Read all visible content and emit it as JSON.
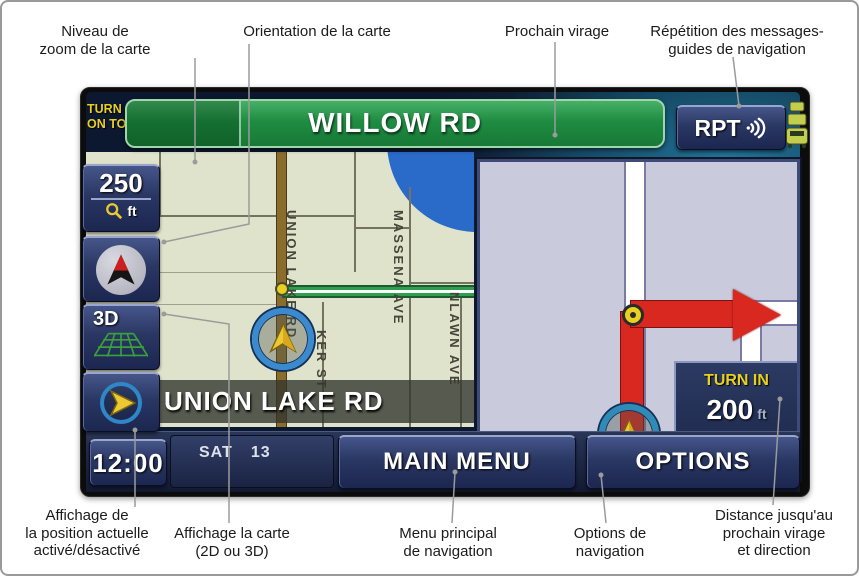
{
  "callouts": {
    "top": [
      {
        "label": "Niveau de\nzoom de la carte"
      },
      {
        "label": "Orientation de la carte"
      },
      {
        "label": "Prochain virage"
      },
      {
        "label": "Répétition des messages-\nguides de navigation"
      }
    ],
    "bottom": [
      {
        "label": "Affichage de\nla position actuelle\nactivé/désactivé"
      },
      {
        "label": "Affichage la carte\n(2D ou 3D)"
      },
      {
        "label": "Menu principal\nde navigation"
      },
      {
        "label": "Options de\nnavigation"
      },
      {
        "label": "Distance jusqu'au\nprochain virage\net direction"
      }
    ]
  },
  "screen": {
    "turn_on_to": "TURN\nON TO",
    "banner": {
      "street": "WILLOW RD"
    },
    "rpt": {
      "label": "RPT",
      "icon": "sound-waves-icon"
    },
    "traffic_icon": "car-stack-icon",
    "zoom_button": {
      "value": "250",
      "unit": "ft",
      "icon": "magnifier-icon"
    },
    "orientation_button": {
      "icon": "north-arrow-icon"
    },
    "view_button": {
      "label": "3D",
      "icon": "grid-3d-icon"
    },
    "position_button": {
      "icon": "position-arrow-icon"
    },
    "map": {
      "current_street": "UNION LAKE RD",
      "streets": {
        "union": "UNION LAKE RD",
        "ker": "KER ST",
        "massena": "MASSENA AVE",
        "nlawn": "NLAWN AVE"
      }
    },
    "turn_panel": {
      "label": "TURN IN",
      "distance": "200",
      "unit": "ft"
    },
    "status_bar": {
      "clock": "12:00",
      "day": "SAT",
      "date": "13",
      "main_menu": "MAIN MENU",
      "options": "OPTIONS"
    }
  },
  "colors": {
    "banner_green": "#1f8c42",
    "route_green": "#2e9e4f",
    "accent_yellow": "#e8d020",
    "button_navy": "#2a3763",
    "map_beige": "#e0e3cb",
    "panel_lavender": "#c9cbdd",
    "route_red": "#d82820",
    "water_blue": "#2a6ac8"
  }
}
